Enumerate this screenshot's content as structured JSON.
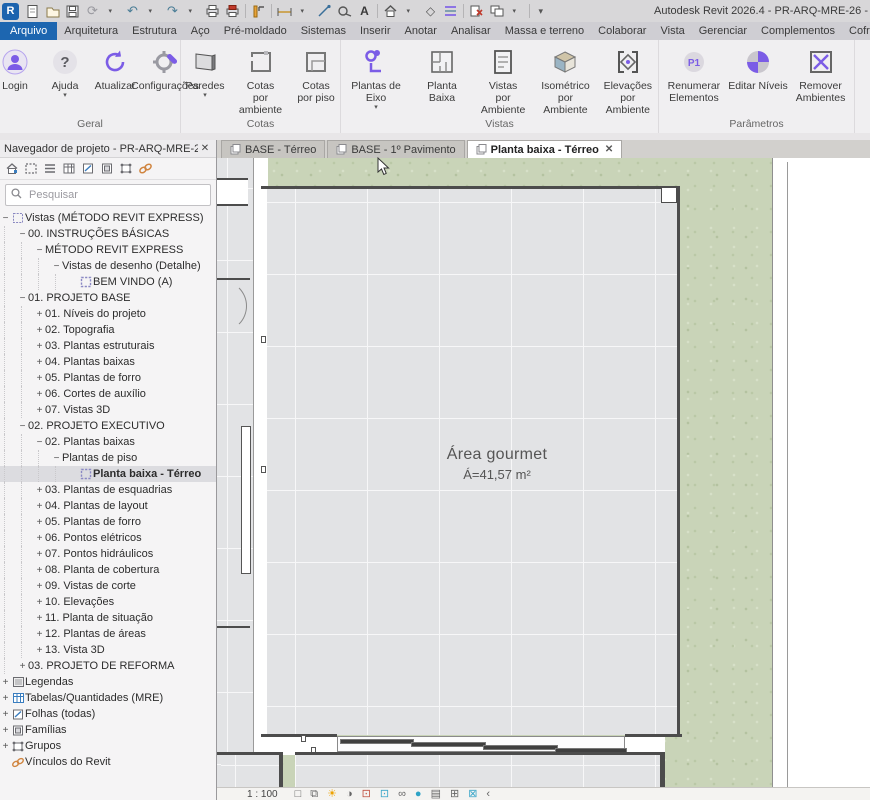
{
  "window": {
    "title": "Autodesk Revit 2026.4 - PR-ARQ-MRE-26 -"
  },
  "qat": {
    "icons": [
      "revit-logo",
      "doc",
      "folder",
      "save",
      "sync",
      "caret",
      "undo",
      "caret",
      "redo",
      "caret",
      "print",
      "print-red",
      "sep",
      "modify",
      "sep",
      "dim",
      "caret",
      "section",
      "tape",
      "textA",
      "sep",
      "home",
      "caret",
      "diamond",
      "listp",
      "sep",
      "closered",
      "wins",
      "caret",
      "sep",
      "caret2"
    ]
  },
  "ribbon": {
    "tabs": [
      {
        "label": "Arquivo",
        "state": "file"
      },
      {
        "label": "Arquitetura",
        "state": ""
      },
      {
        "label": "Estrutura",
        "state": ""
      },
      {
        "label": "Aço",
        "state": ""
      },
      {
        "label": "Pré-moldado",
        "state": ""
      },
      {
        "label": "Sistemas",
        "state": ""
      },
      {
        "label": "Inserir",
        "state": ""
      },
      {
        "label": "Anotar",
        "state": ""
      },
      {
        "label": "Analisar",
        "state": ""
      },
      {
        "label": "Massa e terreno",
        "state": ""
      },
      {
        "label": "Colaborar",
        "state": ""
      },
      {
        "label": "Vista",
        "state": ""
      },
      {
        "label": "Gerenciar",
        "state": ""
      },
      {
        "label": "Complementos",
        "state": ""
      },
      {
        "label": "Cofragem",
        "state": ""
      },
      {
        "label": "DetBox",
        "state": "active"
      }
    ],
    "panels": [
      {
        "label": "Geral",
        "width": 181,
        "buttons": [
          {
            "label": "Login",
            "icon": "login",
            "dropdown": false
          },
          {
            "label": "Ajuda",
            "icon": "help",
            "dropdown": true
          },
          {
            "label": "Atualizar",
            "icon": "refresh",
            "dropdown": false
          },
          {
            "label": "Configurações",
            "icon": "settings",
            "dropdown": false
          }
        ]
      },
      {
        "label": "Cotas",
        "width": 160,
        "buttons": [
          {
            "label": "Paredes",
            "icon": "walls",
            "dropdown": true
          },
          {
            "label": "Cotas\npor ambiente",
            "icon": "roomdim",
            "dropdown": false
          },
          {
            "label": "Cotas\npor piso",
            "icon": "floordim",
            "dropdown": false
          }
        ]
      },
      {
        "label": "Vistas",
        "width": 318,
        "buttons": [
          {
            "label": "Plantas de Eixo",
            "icon": "axisplan",
            "dropdown": true
          },
          {
            "label": "Planta Baixa",
            "icon": "floorplan",
            "dropdown": false
          },
          {
            "label": "Vistas\npor Ambiente",
            "icon": "roomviews",
            "dropdown": false
          },
          {
            "label": "Isométrico\npor Ambiente",
            "icon": "iso",
            "dropdown": false
          },
          {
            "label": "Elevações\npor Ambiente",
            "icon": "elev",
            "dropdown": false
          }
        ]
      },
      {
        "label": "Parâmetros",
        "width": 196,
        "buttons": [
          {
            "label": "Renumerar\nElementos",
            "icon": "renum",
            "dropdown": false
          },
          {
            "label": "Editar Níveis",
            "icon": "levels",
            "dropdown": false
          },
          {
            "label": "Remover\nAmbientes",
            "icon": "removeamb",
            "dropdown": false
          }
        ]
      }
    ]
  },
  "browser": {
    "title": "Navegador de projeto - PR-ARQ-MRE-26",
    "close_glyph": "✕",
    "toolbar": [
      "home",
      "viewport",
      "schedule-list",
      "schedule-table",
      "sheet",
      "family",
      "group",
      "link"
    ],
    "search_placeholder": "Pesquisar",
    "tree": [
      {
        "label": "Vistas (MÉTODO REVIT EXPRESS)",
        "level": 0,
        "exp": "-",
        "icon": "views",
        "sel": false
      },
      {
        "label": "00. INSTRUÇÕES BÁSICAS",
        "level": 1,
        "exp": "-",
        "icon": "",
        "sel": false
      },
      {
        "label": "MÉTODO REVIT EXPRESS",
        "level": 2,
        "exp": "-",
        "icon": "",
        "sel": false
      },
      {
        "label": "Vistas de desenho (Detalhe)",
        "level": 3,
        "exp": "-",
        "icon": "",
        "sel": false
      },
      {
        "label": "BEM VINDO (A)",
        "level": 4,
        "exp": "",
        "icon": "view",
        "sel": false
      },
      {
        "label": "01. PROJETO BASE",
        "level": 1,
        "exp": "-",
        "icon": "",
        "sel": false
      },
      {
        "label": "01. Níveis do projeto",
        "level": 2,
        "exp": "+",
        "icon": "",
        "sel": false
      },
      {
        "label": "02. Topografia",
        "level": 2,
        "exp": "+",
        "icon": "",
        "sel": false
      },
      {
        "label": "03. Plantas estruturais",
        "level": 2,
        "exp": "+",
        "icon": "",
        "sel": false
      },
      {
        "label": "04. Plantas baixas",
        "level": 2,
        "exp": "+",
        "icon": "",
        "sel": false
      },
      {
        "label": "05. Plantas de forro",
        "level": 2,
        "exp": "+",
        "icon": "",
        "sel": false
      },
      {
        "label": "06. Cortes de auxílio",
        "level": 2,
        "exp": "+",
        "icon": "",
        "sel": false
      },
      {
        "label": "07. Vistas 3D",
        "level": 2,
        "exp": "+",
        "icon": "",
        "sel": false
      },
      {
        "label": "02. PROJETO EXECUTIVO",
        "level": 1,
        "exp": "-",
        "icon": "",
        "sel": false
      },
      {
        "label": "02. Plantas baixas",
        "level": 2,
        "exp": "-",
        "icon": "",
        "sel": false
      },
      {
        "label": "Plantas de piso",
        "level": 3,
        "exp": "-",
        "icon": "",
        "sel": false
      },
      {
        "label": "Planta baixa - Térreo",
        "level": 4,
        "exp": "",
        "icon": "view",
        "sel": true
      },
      {
        "label": "03. Plantas de esquadrias",
        "level": 2,
        "exp": "+",
        "icon": "",
        "sel": false
      },
      {
        "label": "04. Plantas de layout",
        "level": 2,
        "exp": "+",
        "icon": "",
        "sel": false
      },
      {
        "label": "05. Plantas de forro",
        "level": 2,
        "exp": "+",
        "icon": "",
        "sel": false
      },
      {
        "label": "06. Pontos elétricos",
        "level": 2,
        "exp": "+",
        "icon": "",
        "sel": false
      },
      {
        "label": "07. Pontos hidráulicos",
        "level": 2,
        "exp": "+",
        "icon": "",
        "sel": false
      },
      {
        "label": "08. Planta de cobertura",
        "level": 2,
        "exp": "+",
        "icon": "",
        "sel": false
      },
      {
        "label": "09. Vistas de corte",
        "level": 2,
        "exp": "+",
        "icon": "",
        "sel": false
      },
      {
        "label": "10. Elevações",
        "level": 2,
        "exp": "+",
        "icon": "",
        "sel": false
      },
      {
        "label": "11. Planta de situação",
        "level": 2,
        "exp": "+",
        "icon": "",
        "sel": false
      },
      {
        "label": "12. Plantas de áreas",
        "level": 2,
        "exp": "+",
        "icon": "",
        "sel": false
      },
      {
        "label": "13. Vista 3D",
        "level": 2,
        "exp": "+",
        "icon": "",
        "sel": false
      },
      {
        "label": "03. PROJETO DE REFORMA",
        "level": 1,
        "exp": "+",
        "icon": "",
        "sel": false
      },
      {
        "label": "Legendas",
        "level": 0,
        "exp": "+",
        "icon": "legend",
        "sel": false
      },
      {
        "label": "Tabelas/Quantidades (MRE)",
        "level": 0,
        "exp": "+",
        "icon": "table",
        "sel": false
      },
      {
        "label": "Folhas (todas)",
        "level": 0,
        "exp": "+",
        "icon": "sheet",
        "sel": false
      },
      {
        "label": "Famílias",
        "level": 0,
        "exp": "+",
        "icon": "family",
        "sel": false
      },
      {
        "label": "Grupos",
        "level": 0,
        "exp": "+",
        "icon": "group",
        "sel": false
      },
      {
        "label": "Vínculos do Revit",
        "level": 0,
        "exp": "",
        "icon": "link",
        "sel": false
      }
    ]
  },
  "view_tabs": [
    {
      "label": "BASE - Térreo",
      "active": false
    },
    {
      "label": "BASE - 1º Pavimento",
      "active": false
    },
    {
      "label": "Planta baixa - Térreo",
      "active": true
    }
  ],
  "canvas": {
    "room_label": "Área gourmet",
    "room_area": "Á=41,57 m²"
  },
  "view_bar": {
    "scale": "1 : 100",
    "icons": [
      "frame",
      "book",
      "sun",
      "shadow",
      "cropr",
      "cropb",
      "glasses",
      "dot",
      "doc",
      "grid",
      "boxsel",
      "chev"
    ]
  },
  "colors": {
    "accent_purple": "#7b5ce6",
    "tab_blue": "#1d66b0",
    "grass": "#c9d4b8",
    "floor": "#e2e3e5",
    "wall": "#4c4c4c",
    "link_orange": "#d08540"
  }
}
